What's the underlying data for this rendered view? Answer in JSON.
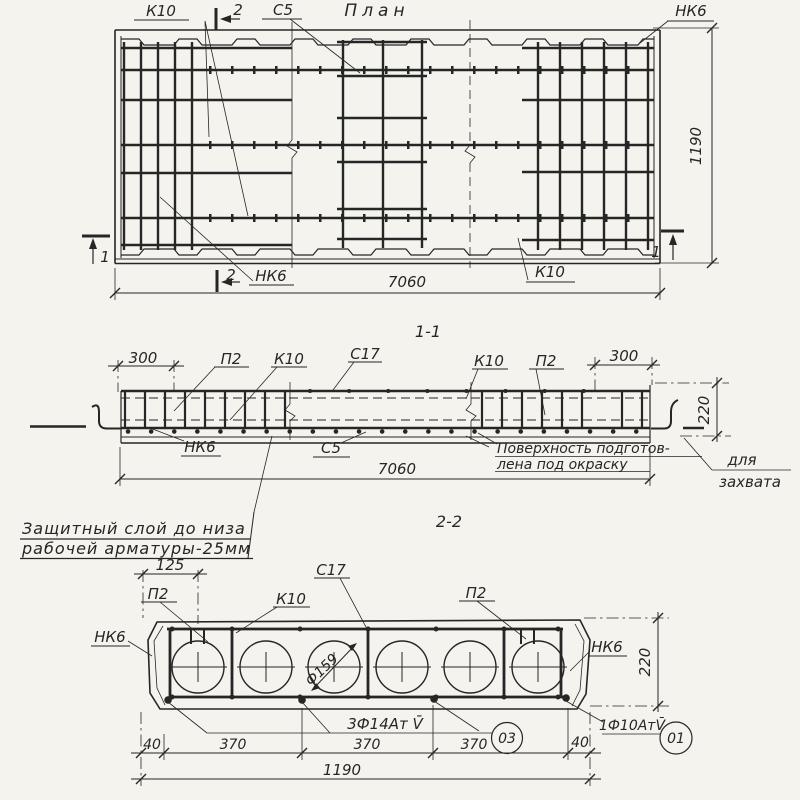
{
  "colors": {
    "paper": "#f4f3ee",
    "ink": "#262626"
  },
  "plan": {
    "title": "План",
    "label_k10_top": "К10",
    "label_c5_top": "С5",
    "label_nk6_top_right": "НК6",
    "label_nk6_bottom": "НК6",
    "label_k10_bottom": "К10",
    "cut_mark_2_top": "2",
    "cut_mark_2_bottom": "2",
    "cut_mark_1_left": "1",
    "cut_mark_1_right": "1",
    "dim_length": "7060",
    "dim_width": "1190"
  },
  "section_1_1": {
    "title": "1-1",
    "dim_300_left": "300",
    "dim_300_right": "300",
    "dim_height": "220",
    "dim_length": "7060",
    "label_p2_left": "П2",
    "label_k10_left": "К10",
    "label_c17": "С17",
    "label_k10_right": "К10",
    "label_p2_right": "П2",
    "label_nk6": "НК6",
    "label_c5": "С5",
    "note_surface_line1": "Поверхность подготов-",
    "note_surface_line2": "лена под окраску",
    "note_grip_line1": "для",
    "note_grip_line2": "захвата"
  },
  "cover_note": {
    "line1": "Защитный слой до низа",
    "line2": "рабочей арматуры-25мм"
  },
  "section_2_2": {
    "title": "2-2",
    "dim_125": "125",
    "dim_height": "220",
    "dim_40_left": "40",
    "dim_370_a": "370",
    "dim_370_b": "370",
    "dim_370_c": "370",
    "dim_40_right": "40",
    "dim_width": "1190",
    "label_p2_left": "П2",
    "label_k10": "К10",
    "label_c17": "С17",
    "label_p2_right": "П2",
    "label_nk6_left": "НК6",
    "label_nk6_right": "НК6",
    "label_void_diameter": "Ф159",
    "label_bottom_bars": "3Ф14Ат V̄",
    "label_corner_bar": "1Ф10АтV̄",
    "mark_03": "03",
    "mark_01": "01"
  }
}
